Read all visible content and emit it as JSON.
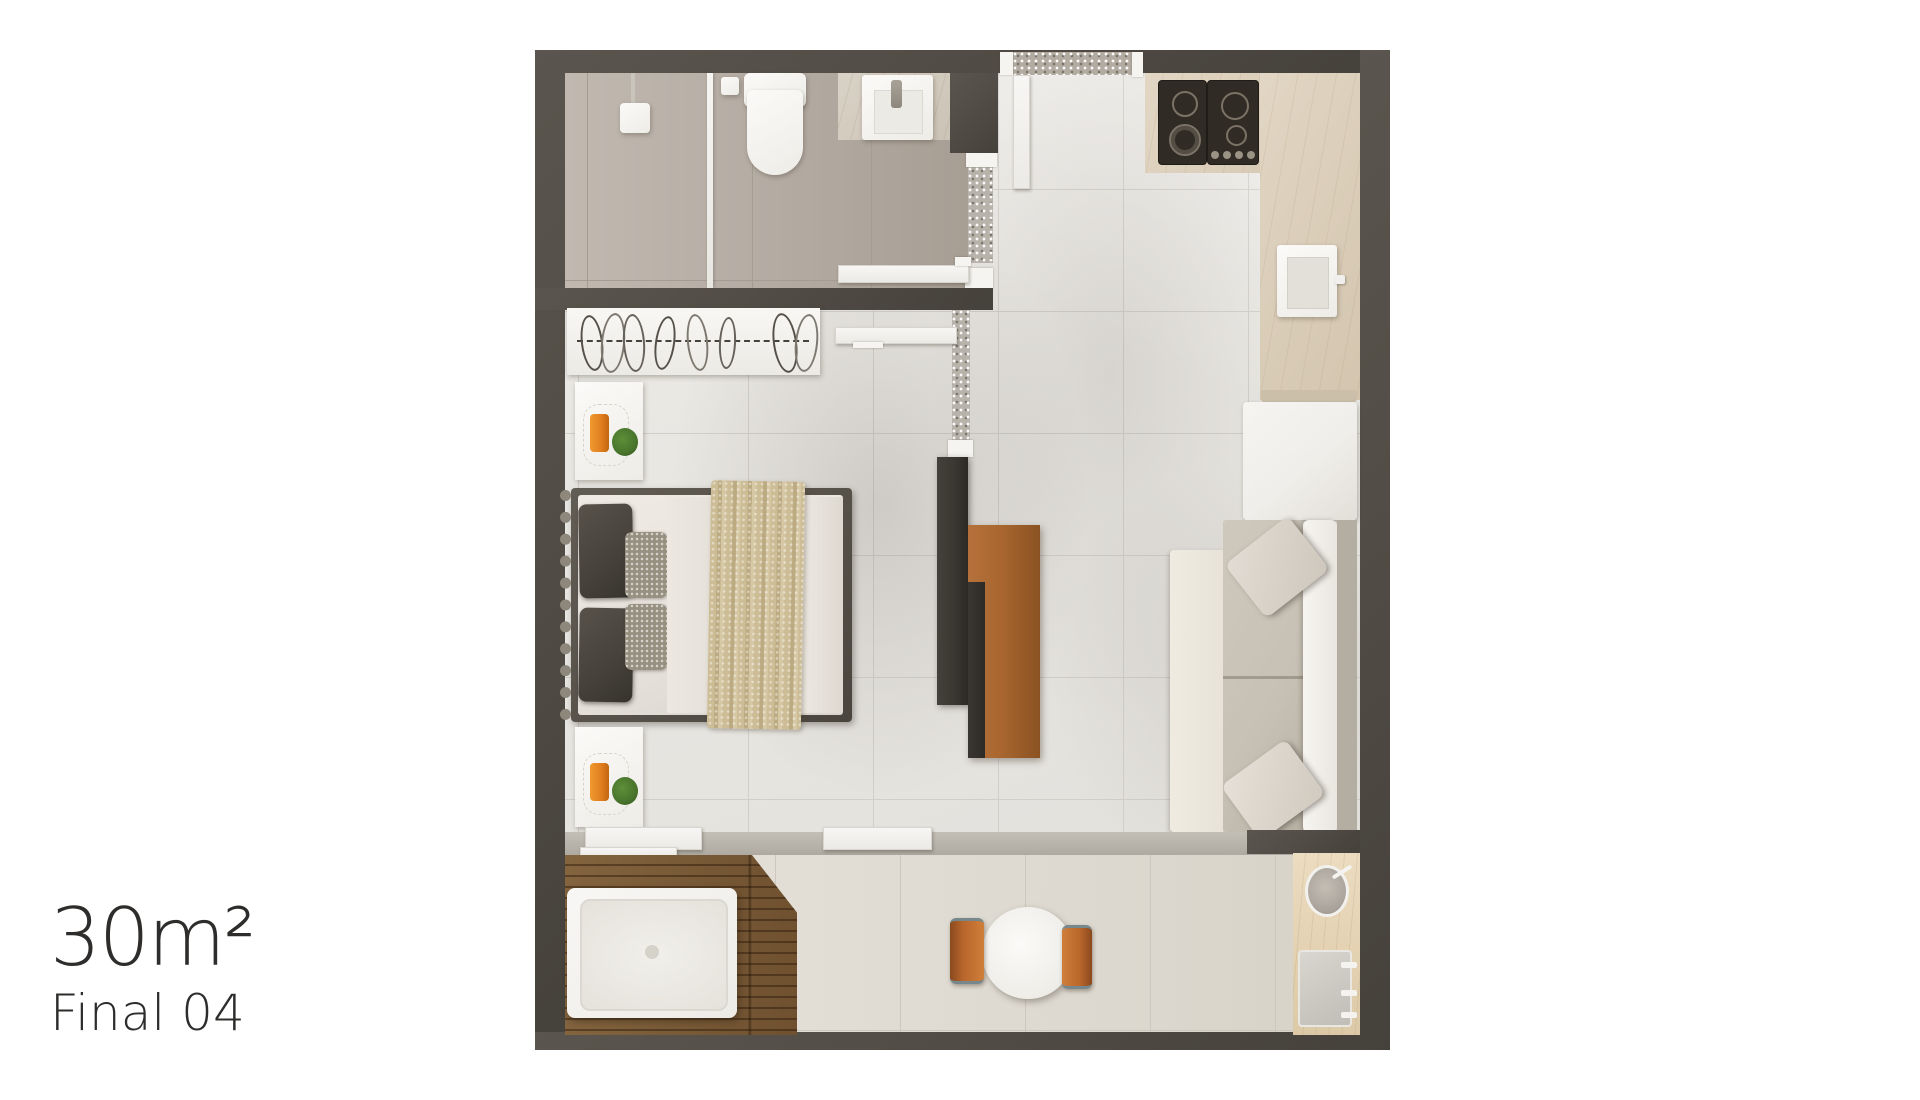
{
  "caption": {
    "area": "30m²",
    "variant": "Final 04"
  },
  "palette": {
    "background": "#ffffff",
    "wall": "#524d46",
    "wall-deep": "#45413b",
    "floor-main": "#eae8e4",
    "floor-grout": "#d2cfc9",
    "floor-bath": "#b9b1a8",
    "bath-grout": "#a59c92",
    "floor-balcony": "#e1ddd4",
    "balcony-grout": "#ccc8be",
    "counter": "#dbcfbc",
    "travertine": "#e6d6ba",
    "stove": "#302b25",
    "wood-deck": "#7d5e3a",
    "tv-wood": "#a9672f",
    "tv-slab": "#3a3630",
    "glass-panel": "#b7b2aa",
    "white-fixture": "#f5f4f1",
    "sofa-seat": "#c7c1b5",
    "sofa-light": "#f0eeea",
    "sofa-chaise": "#e7e3d9",
    "sofa-arm": "#b4aea2",
    "bed-frame": "#57524a",
    "bed-duvet": "#e6e2db",
    "bed-throw": "#c8b893",
    "pillow-dark": "#46423b",
    "pillow-speckle": "#95907f",
    "candle-orange": "#e07d1f",
    "chair-orange": "#b9662c",
    "plant-green": "#49742c",
    "text": "#2e2d2b"
  },
  "floorplan": {
    "description": "Top-down 3D render of a 30 m2 studio apartment, unit Final 04",
    "rooms": [
      "bathroom",
      "bedroom",
      "entry-kitchen-hall",
      "living-room",
      "balcony"
    ],
    "objects": [
      "shower-head",
      "shower-glass-partition",
      "toilet",
      "washbasin",
      "entry-door",
      "doormat",
      "gas-cooktop",
      "kitchen-counter",
      "kitchen-sink",
      "wardrobe-rack",
      "nightstand-candle-plant",
      "double-bed-with-throw",
      "tv-panel",
      "sofa-with-chaise",
      "sliding-glass-doors",
      "wood-deck",
      "hot-tub",
      "bistro-table",
      "orange-chairs",
      "outdoor-counter",
      "outdoor-sink",
      "planter-bowl"
    ]
  }
}
